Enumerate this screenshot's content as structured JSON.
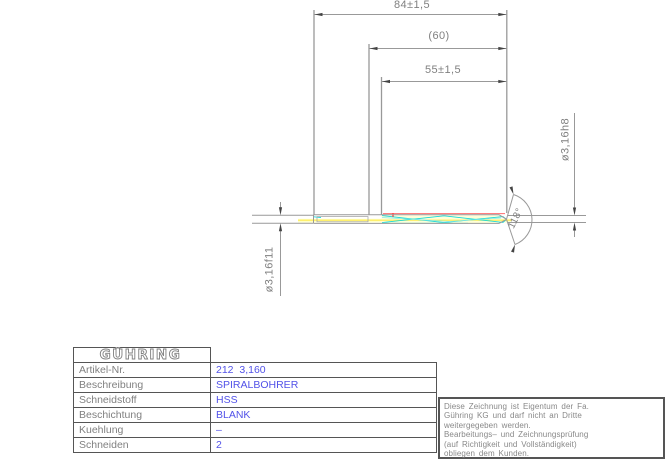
{
  "drawing": {
    "dimensions": {
      "overall_length": "84±1,5",
      "shank_ref_length": "(60)",
      "flute_length": "55±1,5",
      "tip_diameter": "ø3,16h8",
      "shank_diameter": "ø3,16f11",
      "point_angle": "118°"
    }
  },
  "table": {
    "logo": "GÜHRING",
    "rows": [
      {
        "label": "Artikel-Nr.",
        "value": "212  3,160"
      },
      {
        "label": "Beschreibung",
        "value": "SPIRALBOHRER"
      },
      {
        "label": "Schneidstoff",
        "value": "HSS"
      },
      {
        "label": "Beschichtung",
        "value": "BLANK"
      },
      {
        "label": "Kuehlung",
        "value": "–"
      },
      {
        "label": "Schneiden",
        "value": "2"
      }
    ]
  },
  "note": {
    "lines": [
      "Diese Zeichnung ist Eigentum der Fa.",
      "Gühring KG und darf nicht an Dritte",
      "weitergegeben werden.",
      "Bearbeitungs– und Zeichnungsprüfung",
      "(auf Richtigkeit und Vollständigkeit)",
      "obliegen dem Kunden."
    ]
  },
  "colors": {
    "line_gray": "#999999",
    "text_gray": "#808080",
    "value_blue": "#5252e8",
    "flute_cyan": "#17d8d8",
    "center_yellow": "#ffec4d",
    "pale_yellow": "#ffffcc",
    "edge_red": "#ff6b6b",
    "table_border": "#555555"
  }
}
